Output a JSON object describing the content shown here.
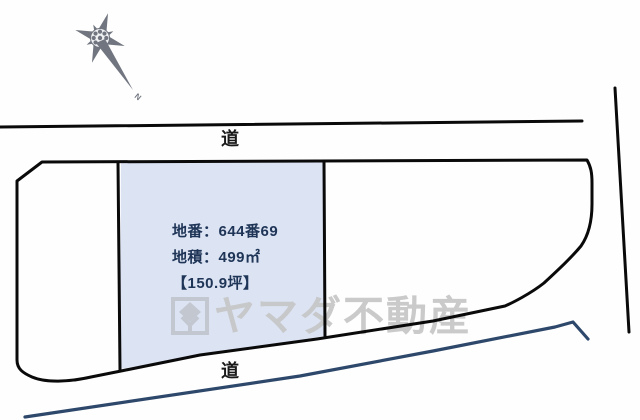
{
  "diagram": {
    "compass": {
      "north_label": "N"
    },
    "road_top": {
      "label": "道"
    },
    "road_bottom": {
      "label": "道"
    },
    "parcel": {
      "lot_line": "地番：644番69",
      "area_line": "地積：499㎡",
      "tsubo_line": "【150.9坪】"
    },
    "watermark": {
      "text": "ヤマダ不動産"
    }
  },
  "colors": {
    "parcel_fill": "#dce3f3",
    "outline": "#0a0a0a",
    "water_line": "#2e486b",
    "parcel_text": "#1f3557",
    "watermark_gray": "#c6c6c6",
    "compass_gray": "#4d5360"
  }
}
